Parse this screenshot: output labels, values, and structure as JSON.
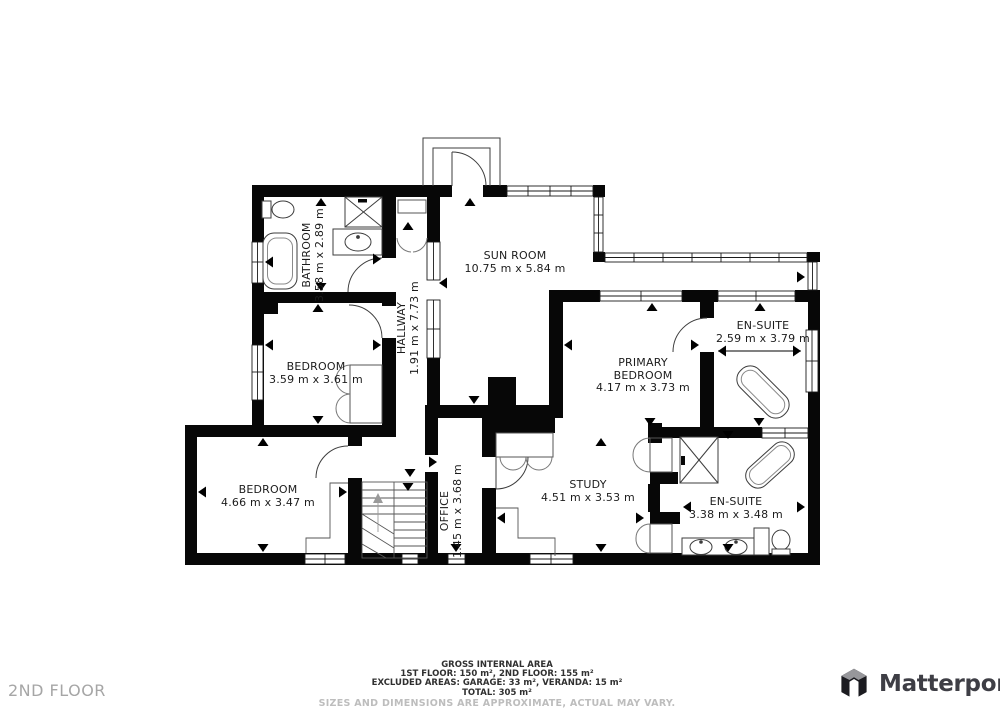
{
  "floor_label": "2ND FLOOR",
  "brand": {
    "name": "Matterport"
  },
  "rooms": [
    {
      "id": "bathroom",
      "name": "BATHROOM",
      "dims": "3.58 m x 2.89 m"
    },
    {
      "id": "sun-room",
      "name": "SUN ROOM",
      "dims": "10.75 m x 5.84 m"
    },
    {
      "id": "hallway",
      "name": "HALLWAY",
      "dims": "1.91 m x 7.73 m"
    },
    {
      "id": "bedroom-west",
      "name": "BEDROOM",
      "dims": "3.59 m x 3.61 m"
    },
    {
      "id": "primary-bedroom",
      "name": "PRIMARY BEDROOM",
      "dims": "4.17 m x 3.73 m"
    },
    {
      "id": "en-suite-north",
      "name": "EN-SUITE",
      "dims": "2.59 m x 3.79 m"
    },
    {
      "id": "bedroom-southwest",
      "name": "BEDROOM",
      "dims": "4.66 m x 3.47 m"
    },
    {
      "id": "office",
      "name": "OFFICE",
      "dims": "1.45 m x 3.68 m"
    },
    {
      "id": "study",
      "name": "STUDY",
      "dims": "4.51 m x 3.53 m"
    },
    {
      "id": "en-suite-south",
      "name": "EN-SUITE",
      "dims": "3.38 m x 3.48 m"
    }
  ],
  "footer": {
    "title": "GROSS INTERNAL AREA",
    "line1": "1ST FLOOR: 150 m², 2ND FLOOR: 155 m²",
    "line2": "EXCLUDED AREAS: GARAGE: 33 m², VERANDA: 15 m²",
    "line3": "TOTAL: 305 m²",
    "disclaimer": "SIZES AND DIMENSIONS ARE APPROXIMATE, ACTUAL MAY VARY."
  }
}
